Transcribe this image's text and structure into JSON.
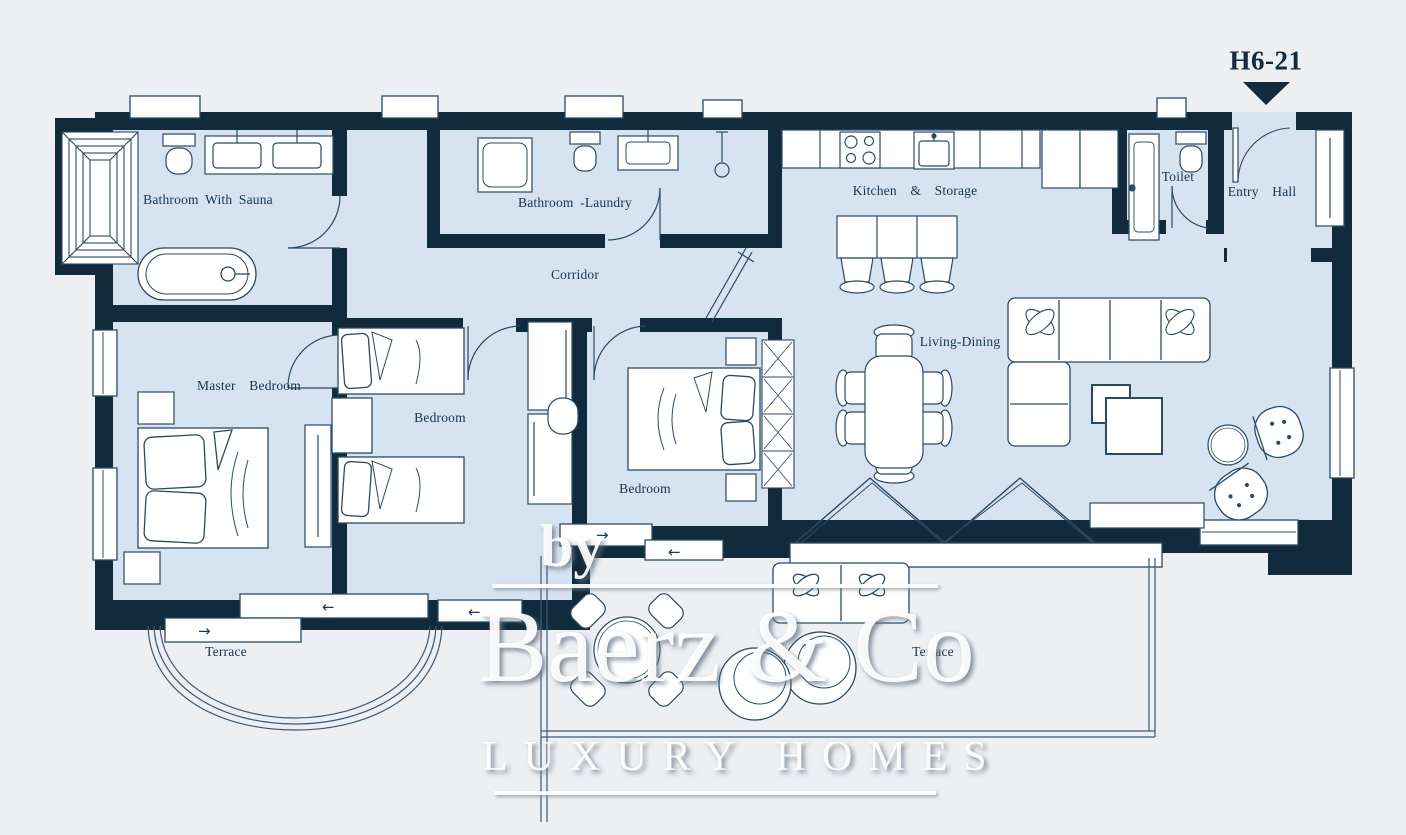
{
  "plan": {
    "unit_label": "H6-21",
    "rooms": [
      {
        "id": "bathroom_sauna",
        "label": "Bathroom With Sauna"
      },
      {
        "id": "bathroom_laundry",
        "label": "Bathroom -Laundry"
      },
      {
        "id": "corridor",
        "label": "Corridor"
      },
      {
        "id": "kitchen_storage",
        "label": "Kitchen & Storage"
      },
      {
        "id": "toilet",
        "label": "Toilet"
      },
      {
        "id": "entry_hall",
        "label": "Entry Hall"
      },
      {
        "id": "master_bedroom",
        "label": "Master Bedroom"
      },
      {
        "id": "bedroom_1",
        "label": "Bedroom"
      },
      {
        "id": "bedroom_2",
        "label": "Bedroom"
      },
      {
        "id": "living_dining",
        "label": "Living-Dining"
      },
      {
        "id": "terrace_left",
        "label": "Terrace"
      },
      {
        "id": "terrace_right",
        "label": "Terrace"
      }
    ],
    "arrows": {
      "left": "←",
      "right": "→"
    },
    "colors": {
      "background": "#edeff3",
      "wall": "#112b3d",
      "floor": "#d8e3f1",
      "furniture_line": "#2a4a63",
      "label_text": "#16344e",
      "watermark": "#ffffff"
    }
  },
  "watermark": {
    "by": "by",
    "brand": "Baerz & Co",
    "tagline": "LUXURY HOMES"
  }
}
